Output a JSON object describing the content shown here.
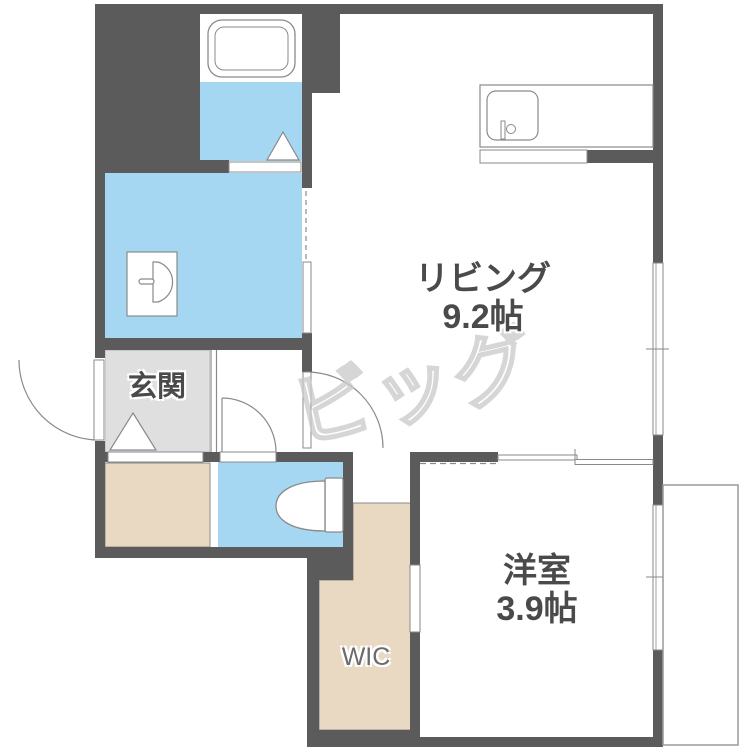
{
  "floorplan": {
    "rooms": {
      "living": {
        "name": "リビング",
        "size": "9.2帖"
      },
      "bedroom": {
        "name": "洋室",
        "size": "3.9帖"
      },
      "entrance": {
        "name": "玄関"
      },
      "wic": {
        "name": "WIC"
      }
    },
    "watermark": "ビッグ",
    "colors": {
      "wall": "#5b5b5b",
      "water": "#a6d7f2",
      "closet": "#e9d8c2",
      "entrance_floor": "#dfdfdf",
      "line": "#8a8a8a"
    }
  }
}
